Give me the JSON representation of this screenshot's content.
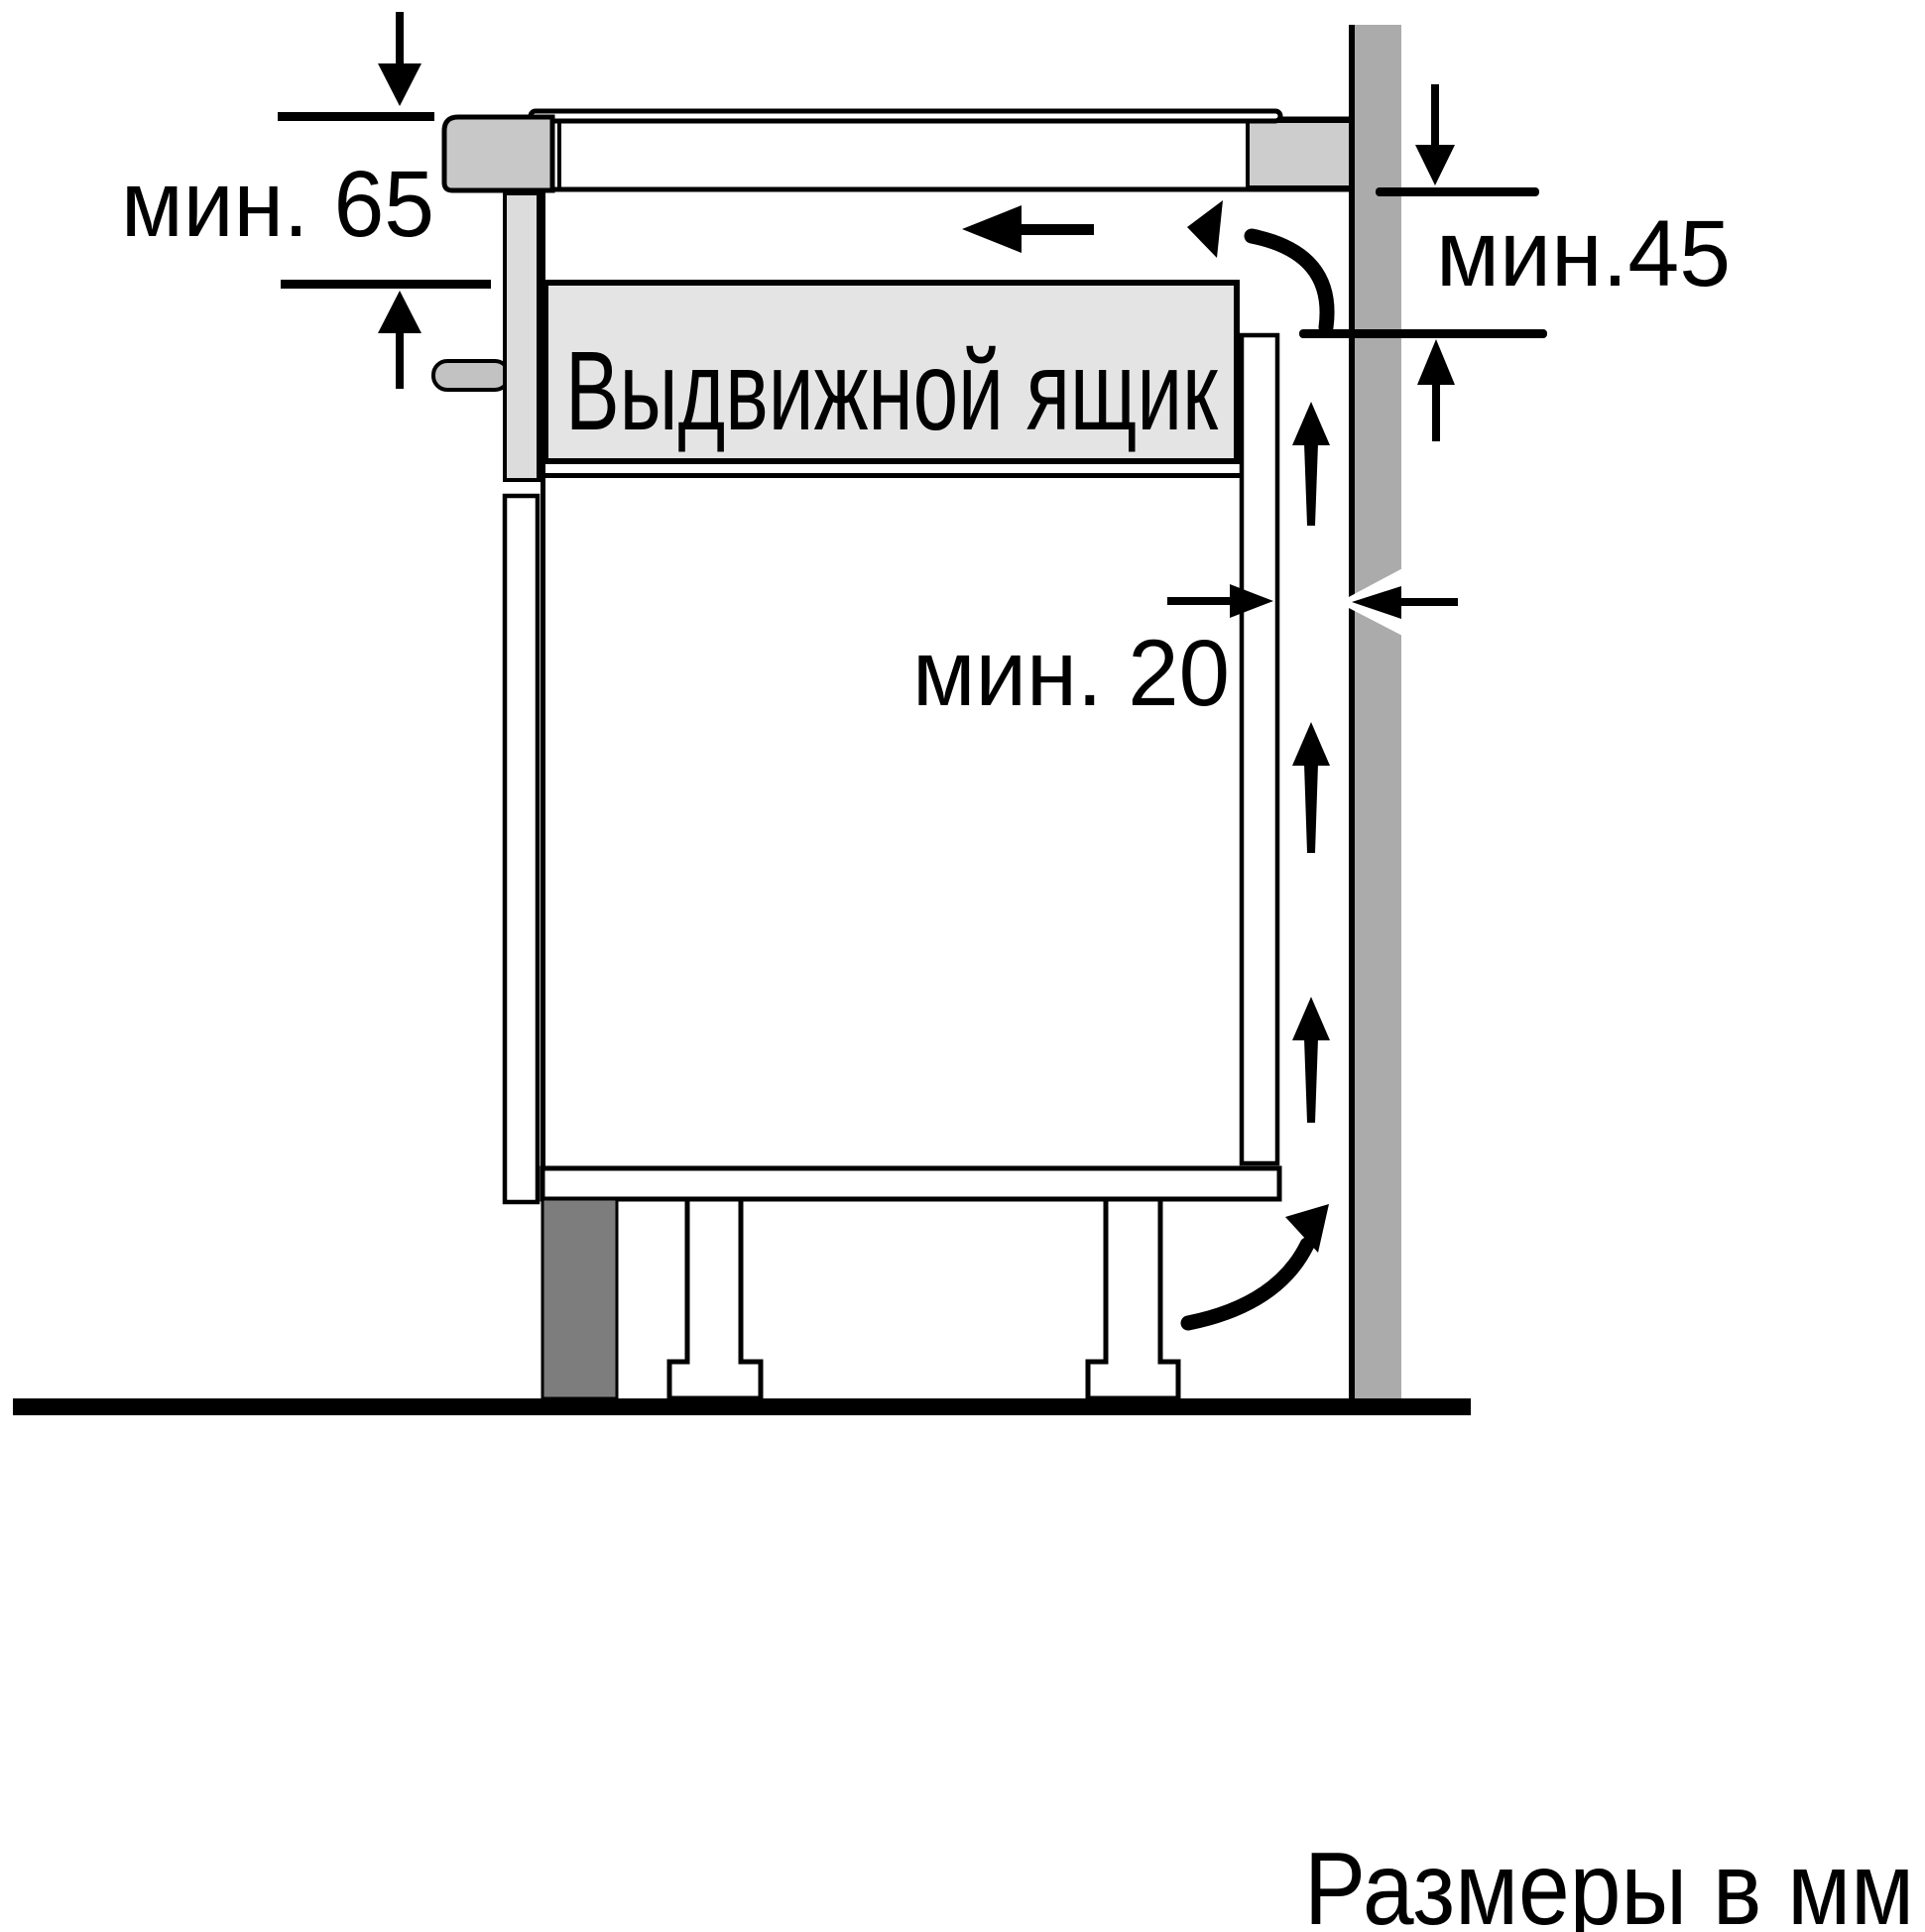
{
  "diagram": {
    "type": "appliance-installation-cross-section",
    "units": "mm",
    "labels": {
      "min_clearance_top": "мин. 65",
      "min_clearance_right": "мин.45",
      "min_gap_wall": "мин. 20",
      "drawer": "Выдвижной ящик",
      "units_note": "Размеры в мм"
    },
    "dimensions": {
      "hob_depth_min": 65,
      "rear_vent_min": 45,
      "wall_gap_min": 20
    },
    "colors": {
      "background": "#ffffff",
      "line": "#000000",
      "wall": "#ababab",
      "worktop_end": "#cdcdcd",
      "hob_body": "#c8c8c8",
      "hob_downstand": "#dcdcdc",
      "fixing_pin": "#c2c2c2",
      "drawer_fill": "#e4e4e4",
      "plinth": "#7d7d7d"
    }
  }
}
